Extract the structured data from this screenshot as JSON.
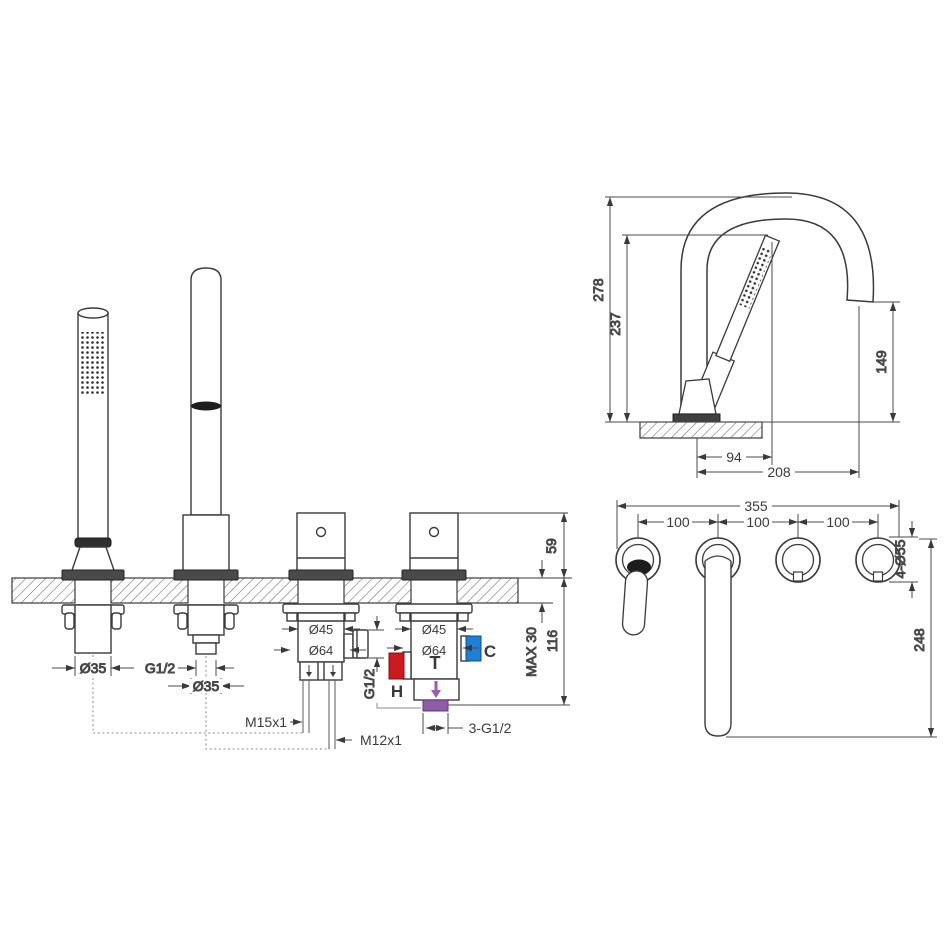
{
  "drawing": {
    "type": "bath-mixer-installation-drawing",
    "colors": {
      "line": "#3a3a3a",
      "hot": "#cc1b20",
      "cold": "#1f7fd2",
      "mixed": "#9a5bb0"
    },
    "front_view": {
      "handshower_diameter": "Ø35",
      "spout_thread": "G1/2",
      "spout_diameter": "Ø35",
      "diverter": {
        "top_diameter": "Ø45",
        "body_diameter": "Ø64",
        "side_port_thread": "G1/2",
        "outlet_left_thread": "M15x1",
        "outlet_right_thread": "M12x1"
      },
      "mixer": {
        "top_diameter": "Ø45",
        "body_diameter": "Ø64",
        "hot_label": "H",
        "cold_label": "C",
        "mix_label": "T",
        "connections_label": "3-G1/2"
      },
      "handle_height": "59",
      "deck_thickness": "MAX 30",
      "under_deck_depth": "116"
    },
    "side_view": {
      "overall_height": "278",
      "handshower_top_height": "237",
      "spout_outlet_height": "149",
      "spout_offset": "94",
      "spout_reach": "208"
    },
    "top_view": {
      "total_span": "355",
      "spacings": [
        "100",
        "100",
        "100"
      ],
      "hole_diameter": "4-Ø55",
      "spout_projection": "248"
    }
  }
}
